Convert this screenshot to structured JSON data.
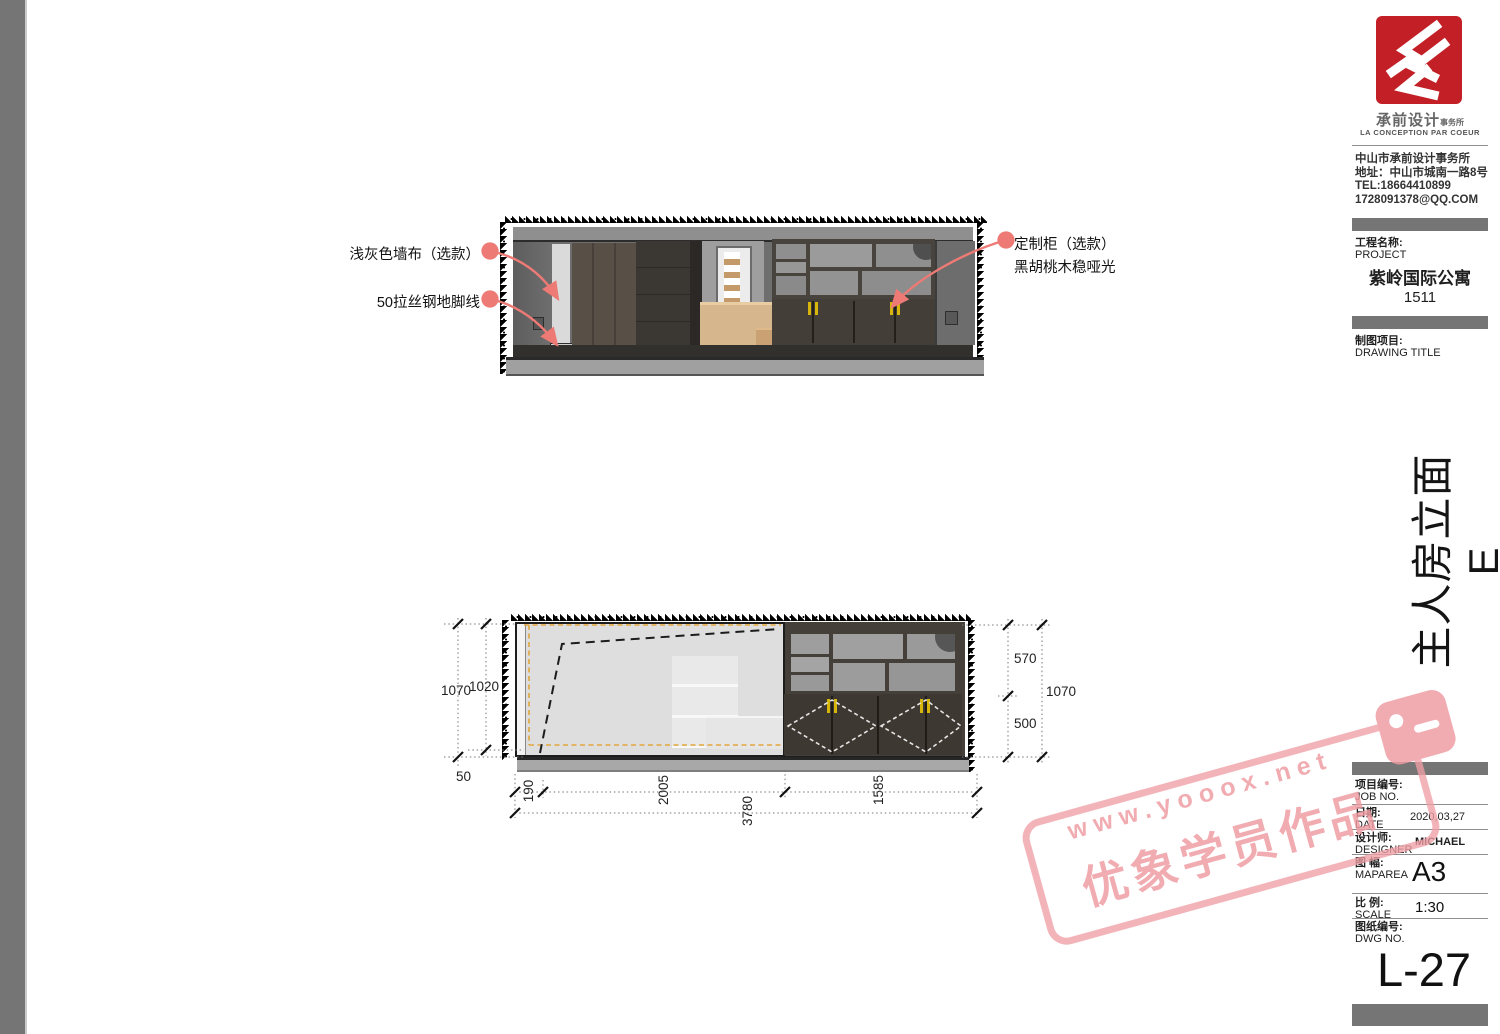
{
  "colors": {
    "accent_red": "#c22026",
    "bar_gray": "#757575",
    "leader_pink": "#ed7a75",
    "stamp_pink": "#ef9aa1",
    "handle_yellow": "#d6b60a"
  },
  "brand": {
    "logo": "chengqian-red-seal",
    "name_cn": "承前设计",
    "name_suffix": "事务所",
    "name_fr": "LA CONCEPTION PAR COEUR"
  },
  "contact": {
    "company": "中山市承前设计事务所",
    "address": "地址：中山市城南一路8号",
    "tel": "TEL:18664410899",
    "email": "1728091378@QQ.COM"
  },
  "project": {
    "label_cn": "工程名称:",
    "label_en": "PROJECT",
    "name": "紫岭国际公寓",
    "unit": "1511"
  },
  "drawing": {
    "label_cn": "制图项目:",
    "label_en": "DRAWING TITLE",
    "vertical_title": "主人房立面E"
  },
  "titleblock": {
    "job_cn": "项目编号:",
    "job_en": "JOB NO.",
    "date_cn": "日期:",
    "date_en": "DATE",
    "date_value": "2020,03,27",
    "designer_cn": "设计师:",
    "designer_en": "DESIGNER",
    "designer_value": "MICHAEL",
    "maparea_cn": "图 幅:",
    "maparea_en": "MAPAREA",
    "maparea_value": "A3",
    "scale_cn": "比 例:",
    "scale_en": "SCALE",
    "scale_value": "1:30",
    "dwg_cn": "图纸编号:",
    "dwg_en": "DWG NO.",
    "dwg_value": "L-27"
  },
  "annotations": {
    "wall_fabric": "浅灰色墙布（选款）",
    "skirting": "50拉丝钢地脚线",
    "cabinet_1": "定制柜（选款）",
    "cabinet_2": "黑胡桃木稳哑光"
  },
  "dims": {
    "left_total": "1070",
    "left_inner": "1020",
    "skirting": "50",
    "right_top": "570",
    "right_total": "1070",
    "right_bottom": "500",
    "b1": "190",
    "b2": "2005",
    "b3": "1585",
    "b_total": "3780"
  },
  "watermark": {
    "url": "www.yooox.net",
    "label": "优象学员作品"
  }
}
